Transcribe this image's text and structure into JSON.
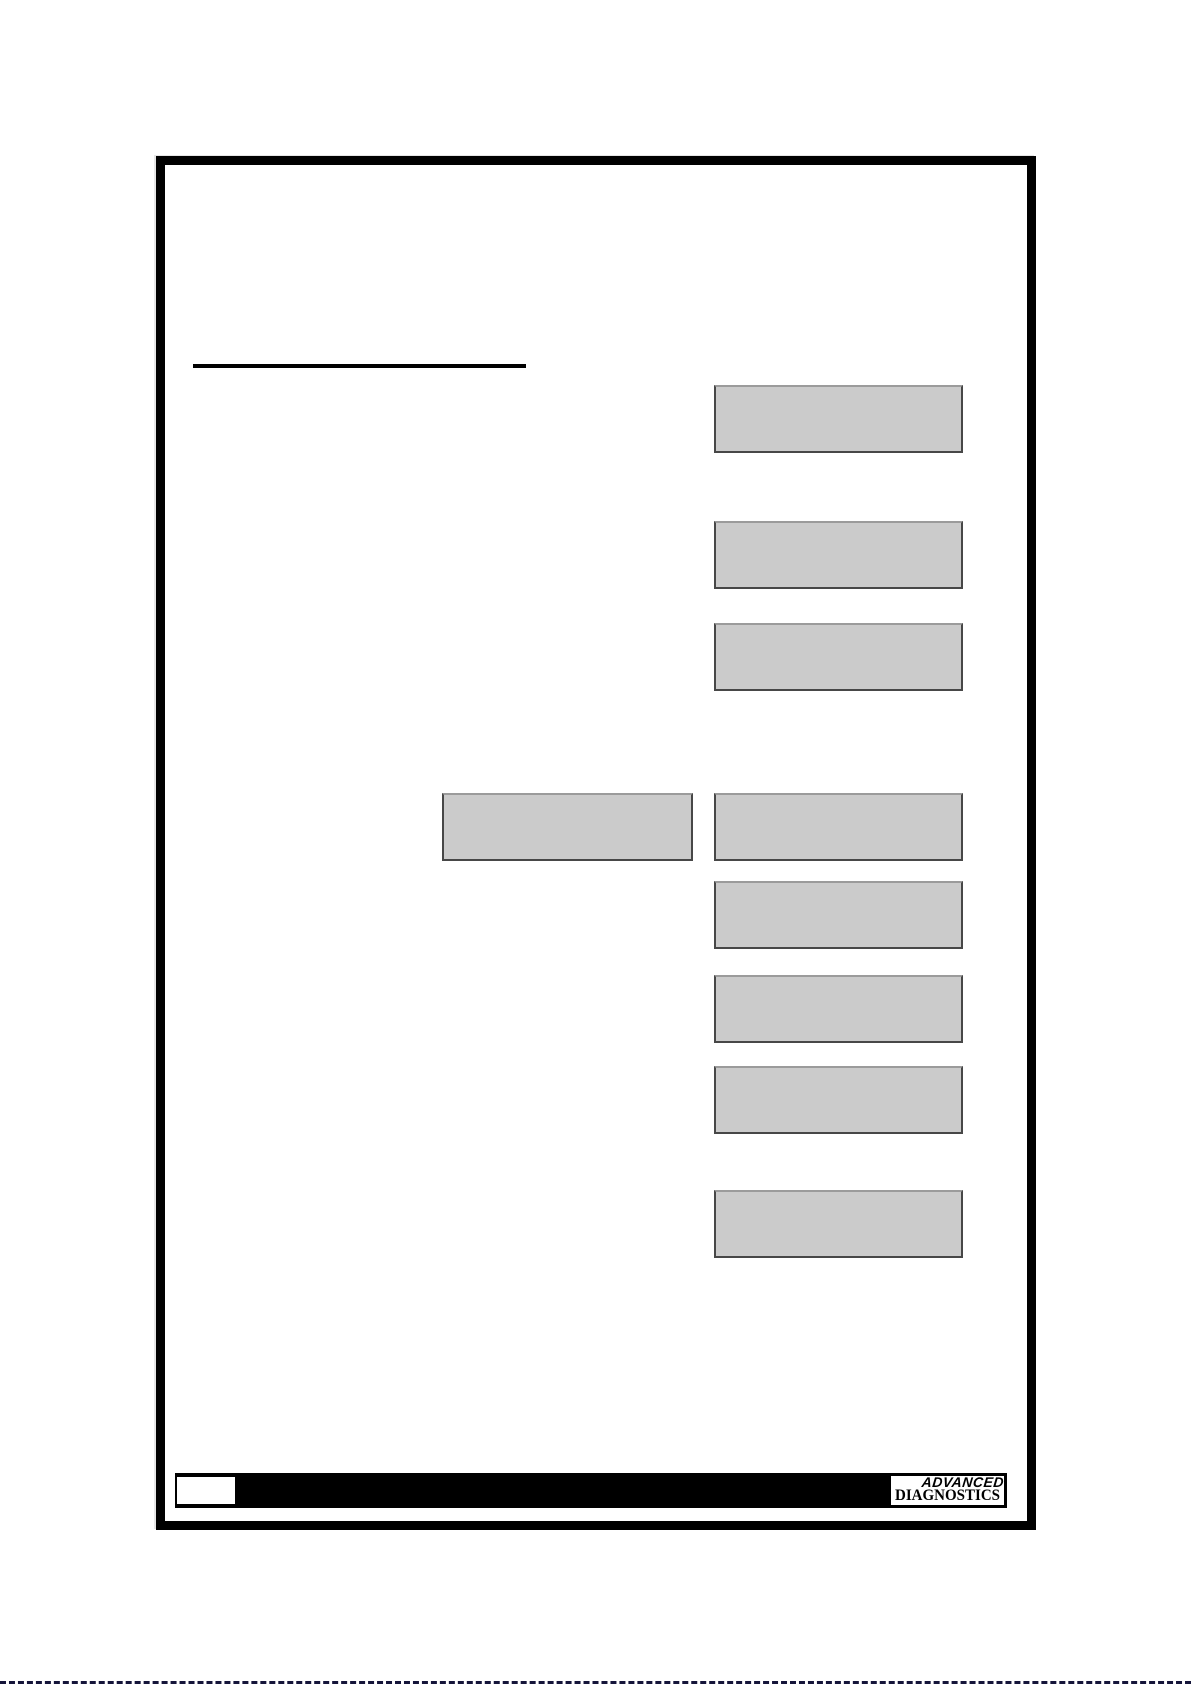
{
  "page": {
    "kind": "blank manual page with placeholder boxes",
    "heading_underline_present": true
  },
  "placeholders": {
    "right_column_count": 8,
    "middle_count": 1
  },
  "footer": {
    "page_number_text": "",
    "logo": {
      "line1": "ADVANCED",
      "line2": "DIAGNOSTICS"
    }
  },
  "colors": {
    "frame": "#000000",
    "footer_bar": "#000000",
    "placeholder_fill": "#cbcbcb",
    "placeholder_border_dark": "#474747",
    "placeholder_border_light": "#9b9b9b",
    "logo_text": "#000000",
    "bottom_line": "#15153a"
  }
}
